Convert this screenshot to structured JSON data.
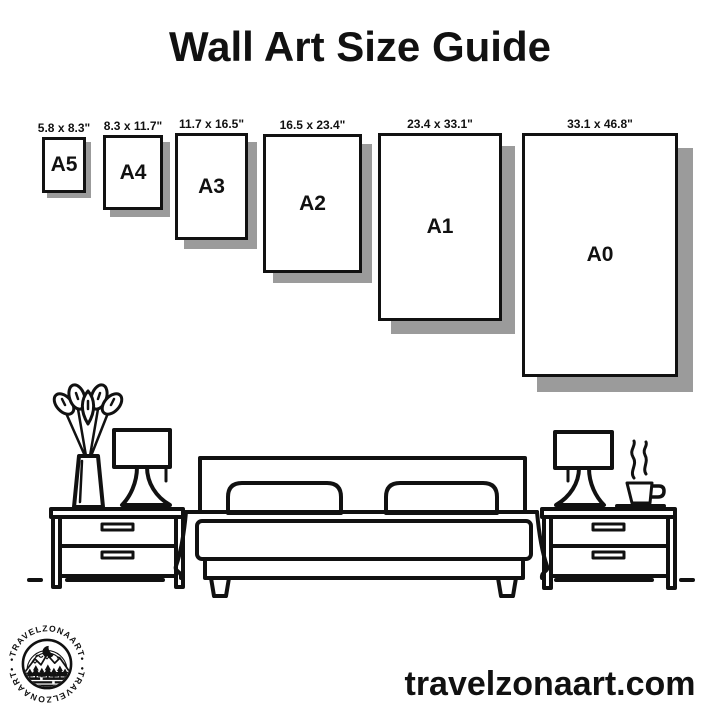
{
  "page": {
    "title": "Wall Art Size Guide",
    "website": "travelzonaart.com"
  },
  "frames": [
    {
      "name": "A5",
      "dimensions": "5.8 x 8.3\""
    },
    {
      "name": "A4",
      "dimensions": "8.3 x 11.7\""
    },
    {
      "name": "A3",
      "dimensions": "11.7 x 16.5\""
    },
    {
      "name": "A2",
      "dimensions": "16.5 x 23.4\""
    },
    {
      "name": "A1",
      "dimensions": "23.4 x 33.1\""
    },
    {
      "name": "A0",
      "dimensions": "33.1 x 46.8\""
    }
  ],
  "logo": {
    "top_text": "•TRAVELZONAART•",
    "bottom_text": "•TRAVELZONAART•"
  },
  "icons": {
    "plant": "plant-vase-icon",
    "lamp_left": "table-lamp-left-icon",
    "lamp_right": "table-lamp-right-icon",
    "nightstand_left": "nightstand-left-icon",
    "nightstand_right": "nightstand-right-icon",
    "bed": "double-bed-icon",
    "coffee": "coffee-cup-icon",
    "floor": "floor-line",
    "moon": "crescent-moon-icon",
    "mountains": "mountains-icon",
    "trees": "pine-trees-icon"
  },
  "colors": {
    "ink": "#111111",
    "shadow": "#9b9b9b",
    "background": "#ffffff"
  }
}
